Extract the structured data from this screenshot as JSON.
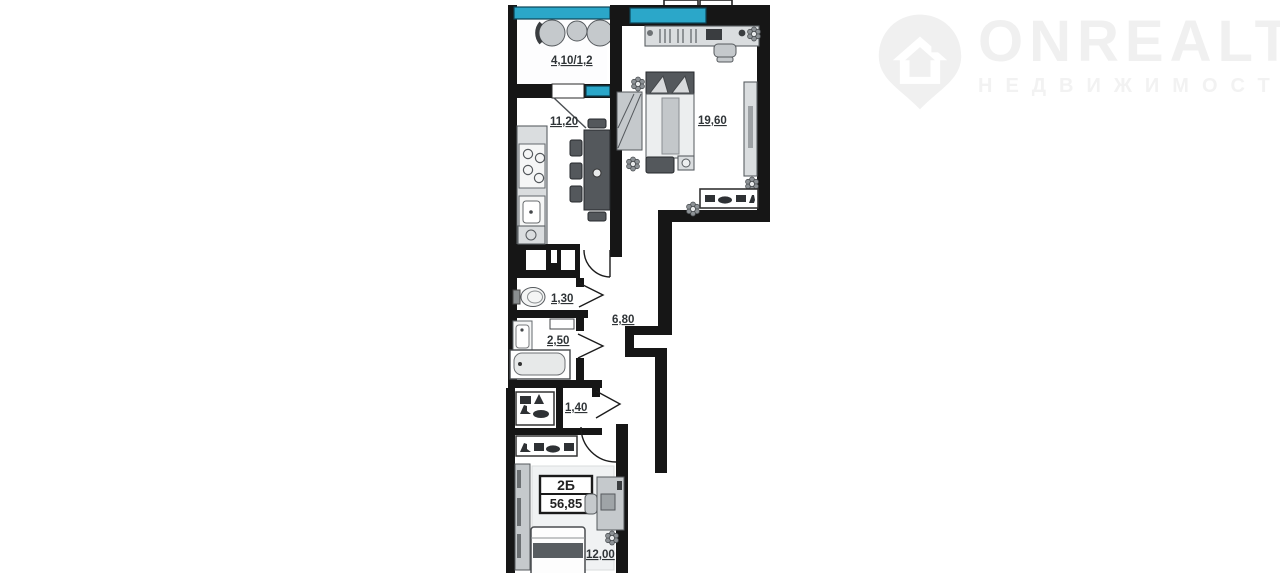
{
  "watermark": {
    "brand": "ONREALT",
    "subtitle": "НЕДВИЖИМОСТЬ"
  },
  "plan": {
    "balcony_area": "4,10/1,2",
    "kitchen_area": "11,20",
    "living_area": "19,60",
    "wc_area": "1,30",
    "hall_area": "6,80",
    "bath_area": "2,50",
    "closet_area": "1,40",
    "bedroom_area": "12,00",
    "unit_label": "2Б",
    "total_area": "56,85"
  },
  "colors": {
    "wall": "#161616",
    "window": "#2ba7c9",
    "watermark": "#f0f0f0"
  }
}
